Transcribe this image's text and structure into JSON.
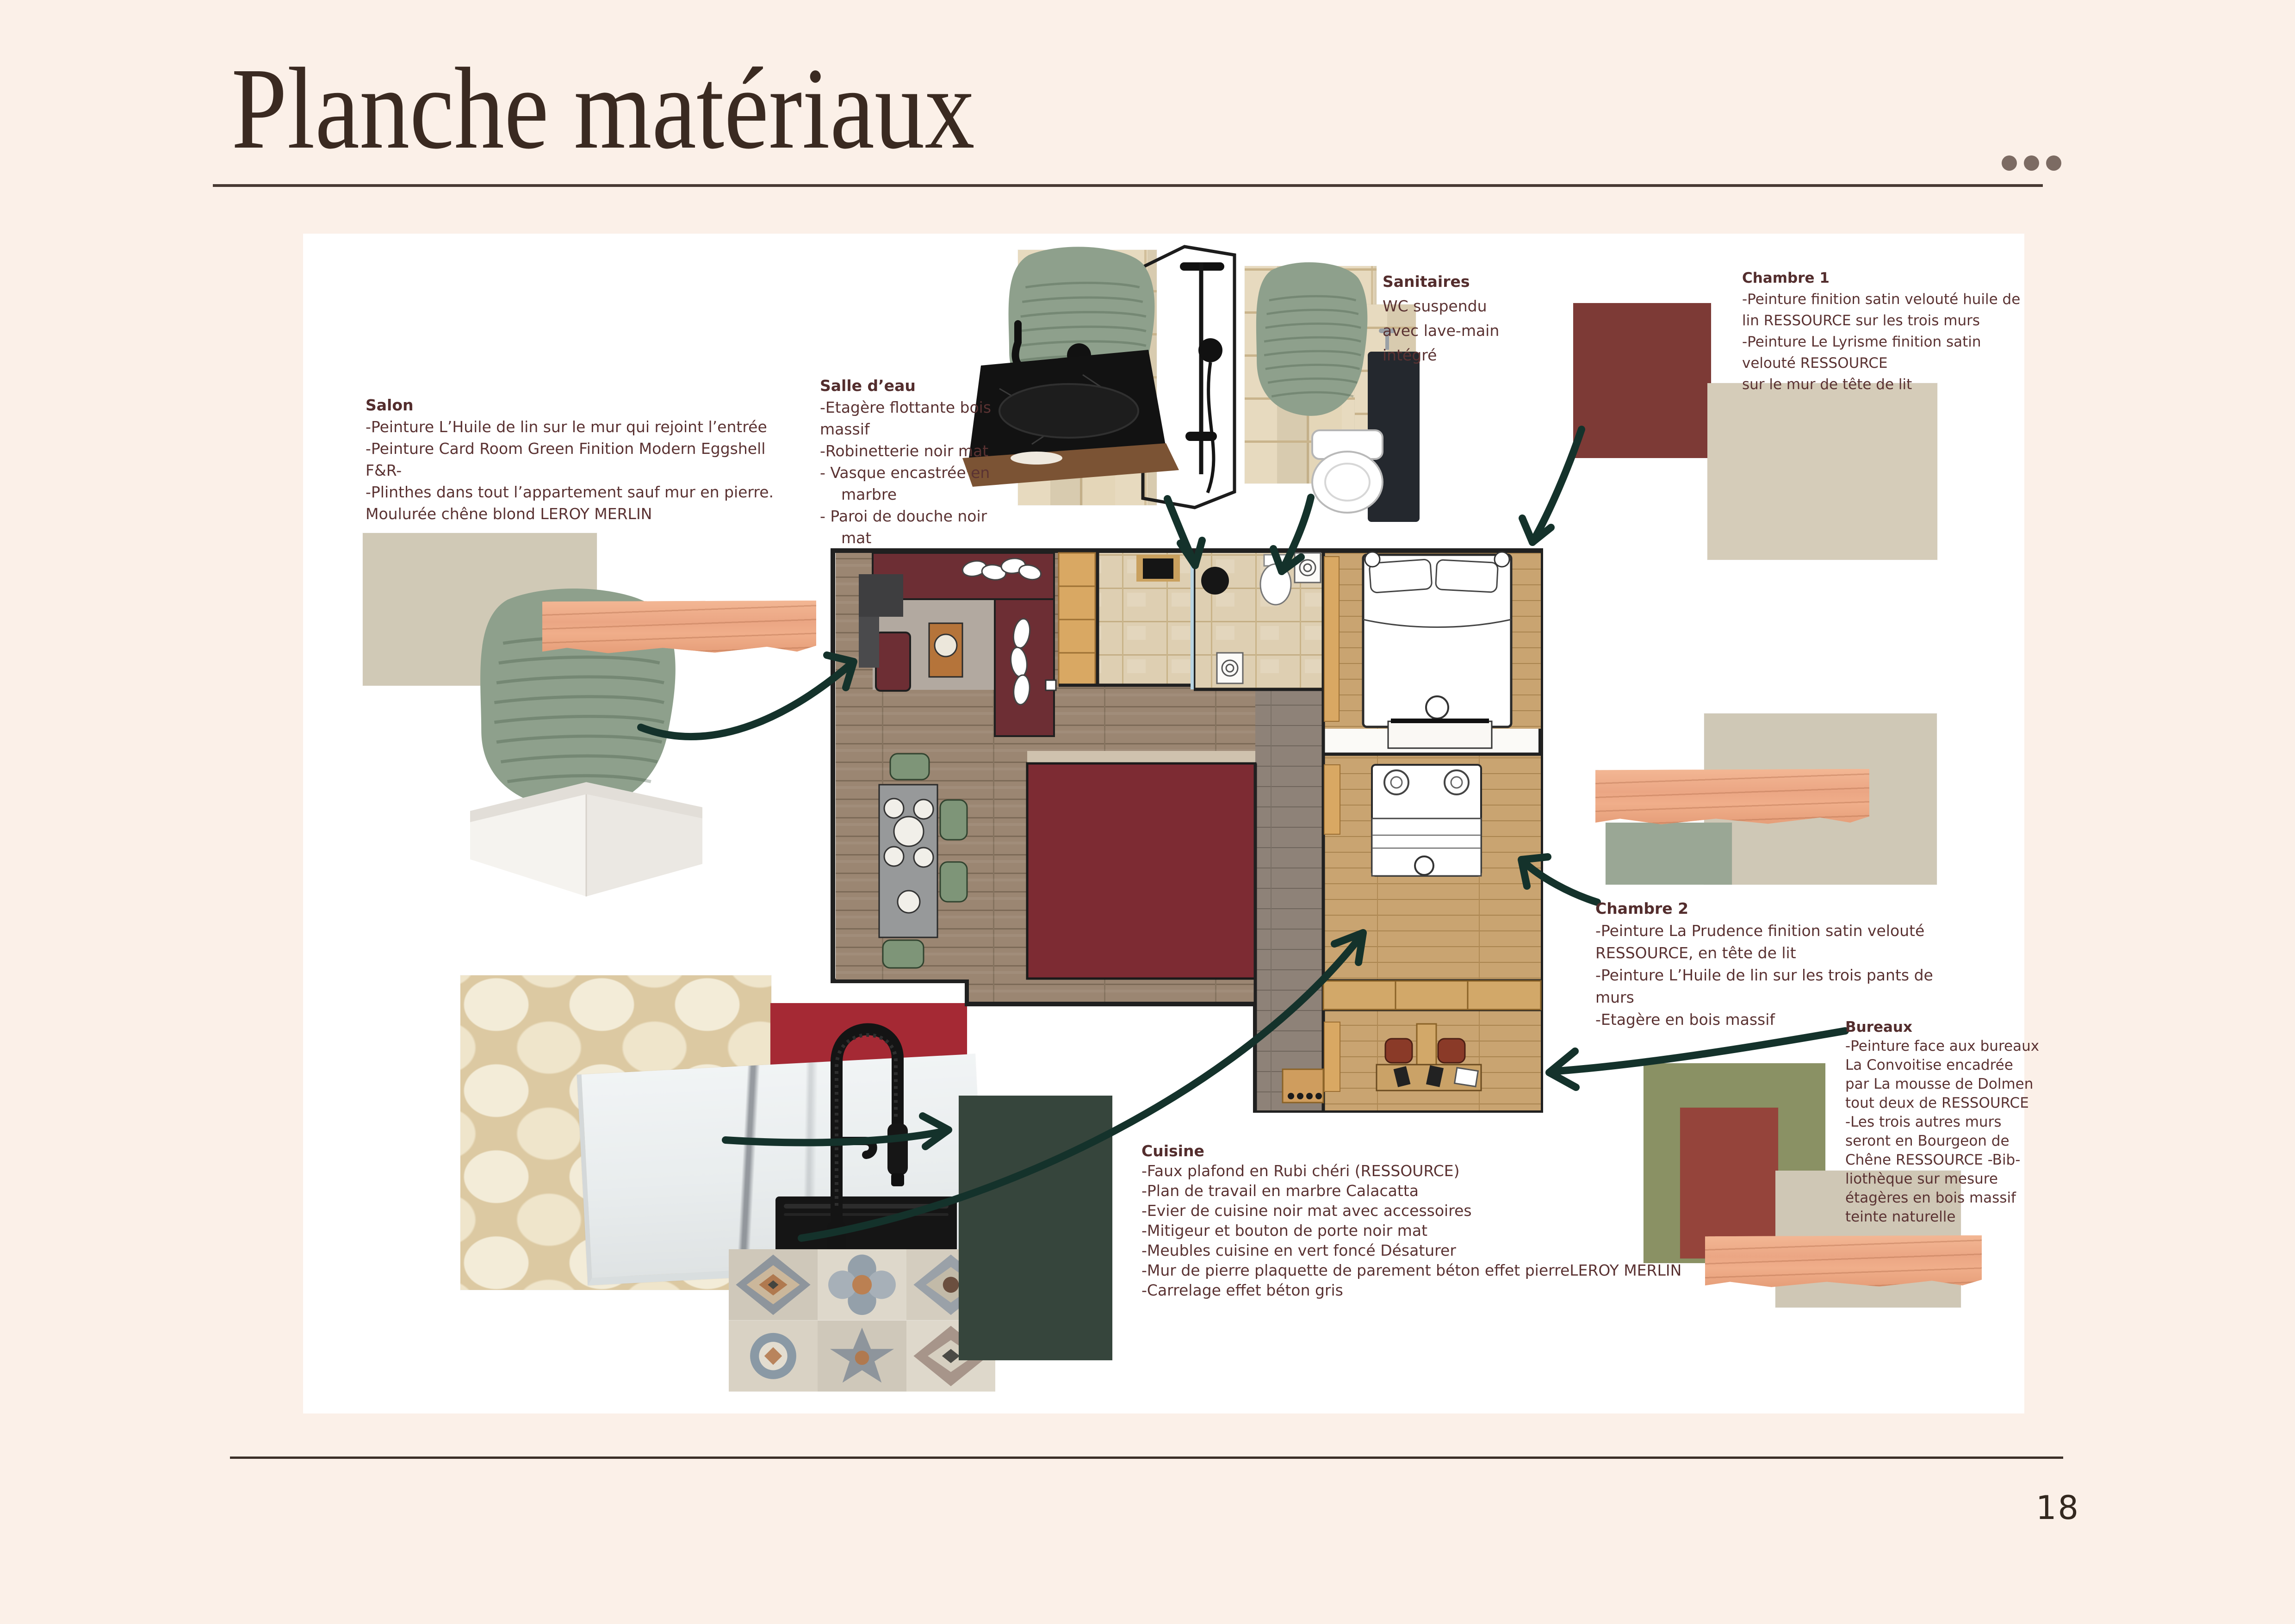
{
  "page": {
    "title": "Planche matériaux",
    "page_number": "18"
  },
  "icons": {
    "header_menu": "ellipsis-icon"
  },
  "annotations": {
    "salon": {
      "heading": "Salon",
      "lines": [
        "-Peinture L’Huile de lin sur le mur qui rejoint l’entrée",
        "-Peinture Card Room Green Finition Modern Eggshell",
        "F&R-",
        "-Plinthes dans tout l’appartement sauf mur en pierre.",
        "Moulurée chêne blond LEROY MERLIN"
      ]
    },
    "salle_eau": {
      "heading": "Salle d’eau",
      "lines": [
        "-Etagère flottante bois",
        "massif",
        "-Robinetterie noir mat",
        "- Vasque encastrée en",
        "marbre",
        "- Paroi de douche noir",
        "mat"
      ]
    },
    "sanitaires": {
      "heading": "Sanitaires",
      "lines": [
        "WC suspendu",
        "avec lave-main",
        "intégré"
      ]
    },
    "chambre1": {
      "heading": "Chambre 1",
      "lines": [
        "-Peinture finition satin velouté huile de",
        "lin RESSOURCE sur les trois murs",
        "-Peinture Le Lyrisme finition satin",
        "velouté RESSOURCE",
        "sur le mur de tête de lit"
      ]
    },
    "chambre2": {
      "heading": "Chambre 2",
      "lines": [
        "-Peinture La Prudence finition satin velouté",
        "RESSOURCE, en tête de lit",
        "-Peinture L’Huile de lin sur les trois pants de",
        "murs",
        "-Etagère en bois massif"
      ]
    },
    "bureaux": {
      "heading": "Bureaux",
      "lines": [
        "-Peinture face aux bureaux",
        "La Convoitise encadrée",
        "par La mousse de Dolmen",
        "tout deux de RESSOURCE",
        "-Les trois autres murs",
        "seront en Bourgeon de",
        "Chêne RESSOURCE -Bib-",
        "liothèque sur mesure",
        "étagères en bois massif",
        "teinte naturelle"
      ]
    },
    "cuisine": {
      "heading": "Cuisine",
      "lines": [
        "-Faux plafond en Rubi chéri (RESSOURCE)",
        "-Plan de travail en marbre Calacatta",
        "-Evier de cuisine noir mat avec accessoires",
        "-Mitigeur et bouton de porte noir mat",
        "-Meubles cuisine en vert foncé Désaturer",
        "-Mur de pierre plaquette de parement béton effet pierreLEROY MERLIN",
        "-Carrelage effet béton gris"
      ]
    }
  },
  "palette": {
    "sage_green_paint": "#8ea08c",
    "beige_linen_paint": "#d0c9b6",
    "maroon_paint": "#7d3a36",
    "brick_red_paint": "#95443b",
    "crimson_red_paint": "#a52934",
    "olive_green_paint": "#8a9164",
    "dark_green_cabinet": "#36453c",
    "blond_oak_wood": "#eeab87",
    "page_background": "#fbf0e8",
    "text_maroon": "#5a3232"
  }
}
